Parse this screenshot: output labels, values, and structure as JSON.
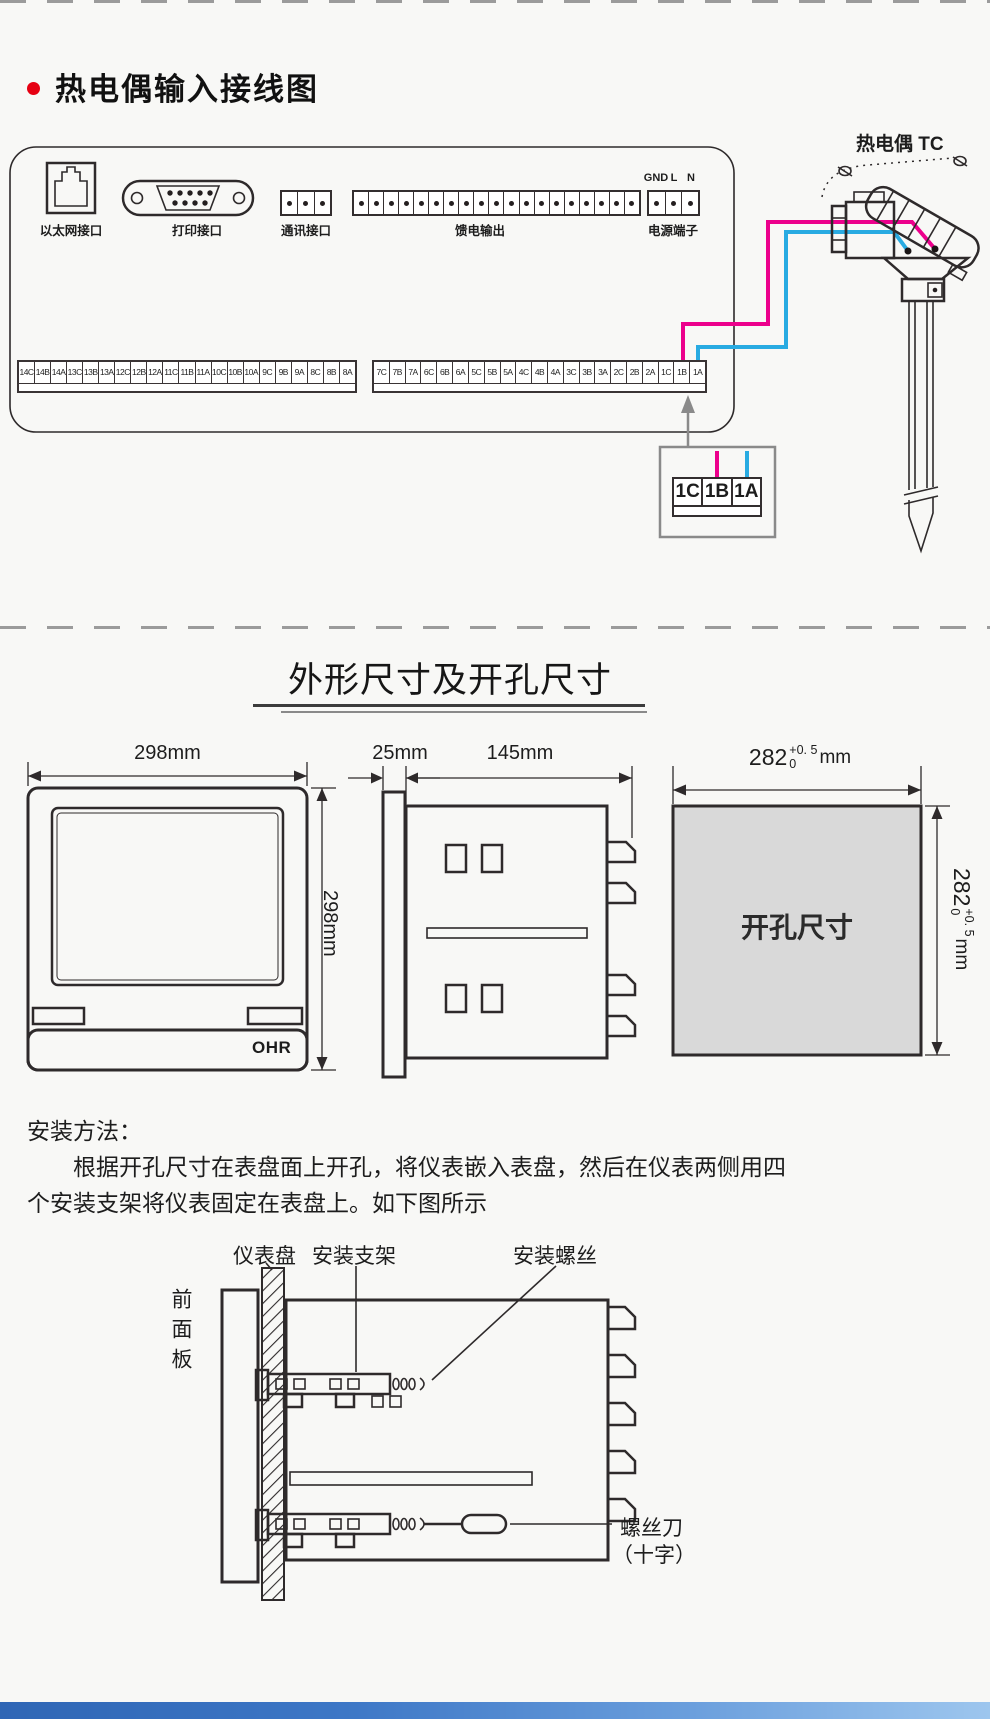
{
  "header": {
    "title": "热电偶输入接线图"
  },
  "wiring": {
    "tc_label": "热电偶 TC",
    "labels": {
      "ethernet": "以太网接口",
      "printer": "打印接口",
      "comm": "通讯接口",
      "feed": "馈电输出",
      "power": "电源端子"
    },
    "power_pins": [
      "GND",
      "L",
      "N"
    ],
    "left_strip": [
      "14C",
      "14B",
      "14A",
      "13C",
      "13B",
      "13A",
      "12C",
      "12B",
      "12A",
      "11C",
      "11B",
      "11A",
      "10C",
      "10B",
      "10A",
      "9C",
      "9B",
      "9A",
      "8C",
      "8B",
      "8A"
    ],
    "right_strip": [
      "7C",
      "7B",
      "7A",
      "6C",
      "6B",
      "6A",
      "5C",
      "5B",
      "5A",
      "4C",
      "4B",
      "4A",
      "3C",
      "3B",
      "3A",
      "2C",
      "2B",
      "2A",
      "1C",
      "1B",
      "1A"
    ],
    "detail_strip": [
      "1C",
      "1B",
      "1A"
    ],
    "wire_colors": {
      "tc_plus": "#ec008c",
      "tc_minus": "#29abe2"
    }
  },
  "dims": {
    "section_title": "外形尺寸及开孔尺寸",
    "front_width": "298mm",
    "front_height": "298mm",
    "bezel_depth": "25mm",
    "body_depth": "145mm",
    "brand": "OHR",
    "cutout_text": "开孔尺寸",
    "cutout_w": {
      "value": "282",
      "tol_plus": "+0. 5",
      "tol_minus": "0",
      "unit": "mm"
    },
    "cutout_h": {
      "value": "282",
      "tol_plus": "+0. 5",
      "tol_minus": "0",
      "unit": "mm"
    }
  },
  "install": {
    "heading": "安装方法：",
    "line1": "根据开孔尺寸在表盘面上开孔，将仪表嵌入表盘，然后在仪表两侧用四",
    "line2": "个安装支架将仪表固定在表盘上。如下图所示",
    "labels": {
      "panel": "仪表盘",
      "bracket": "安装支架",
      "screw": "安装螺丝",
      "front_panel": "前面板",
      "screwdriver": "螺丝刀",
      "screwdriver_type": "（十字）"
    }
  }
}
